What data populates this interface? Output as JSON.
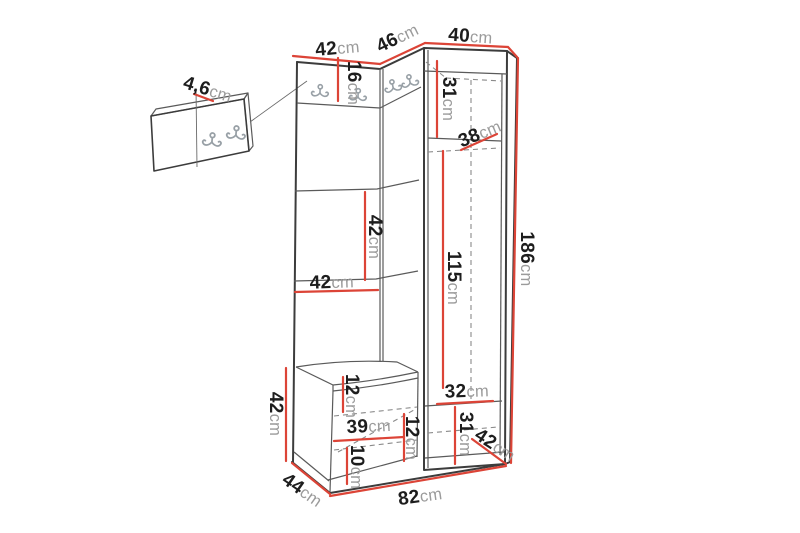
{
  "diagram": {
    "kind": "furniture-dimension-drawing",
    "unit_symbol": "cm"
  },
  "dims": {
    "top_left_width": {
      "value": "42",
      "unit": "cm"
    },
    "top_middle_width": {
      "value": "46",
      "unit": "cm"
    },
    "top_right_width": {
      "value": "40",
      "unit": "cm"
    },
    "hook_panel_thickness": {
      "value": "4,6",
      "unit": "cm"
    },
    "hook_band_height": {
      "value": "16",
      "unit": "cm"
    },
    "cabinet_top_height": {
      "value": "31",
      "unit": "cm"
    },
    "corner_shelf_depth": {
      "value": "38",
      "unit": "cm"
    },
    "open_shelf_height": {
      "value": "42",
      "unit": "cm"
    },
    "open_shelf_width": {
      "value": "42",
      "unit": "cm"
    },
    "cabinet_inner_height": {
      "value": "115",
      "unit": "cm"
    },
    "total_height": {
      "value": "186",
      "unit": "cm"
    },
    "bench_height": {
      "value": "42",
      "unit": "cm"
    },
    "seat_inner_height": {
      "value": "12",
      "unit": "cm"
    },
    "bench_inner_width": {
      "value": "39",
      "unit": "cm"
    },
    "bench_mid_clearance": {
      "value": "12",
      "unit": "cm"
    },
    "bench_lower_clearance": {
      "value": "10",
      "unit": "cm"
    },
    "cabinet_bottom_width": {
      "value": "32",
      "unit": "cm"
    },
    "cabinet_bottom_height": {
      "value": "31",
      "unit": "cm"
    },
    "cabinet_depth": {
      "value": "42",
      "unit": "cm"
    },
    "bench_depth": {
      "value": "44",
      "unit": "cm"
    },
    "total_width": {
      "value": "82",
      "unit": "cm"
    }
  },
  "colors": {
    "dimension_line": "#dc4437",
    "outline": "#3c3c3c",
    "inner_line": "#5a5a5a",
    "dashed_line": "#8a8a8a",
    "hook": "#98a0a6",
    "value_text": "#1d1d1d",
    "unit_text": "#9b9b9b",
    "background": "#ffffff"
  }
}
